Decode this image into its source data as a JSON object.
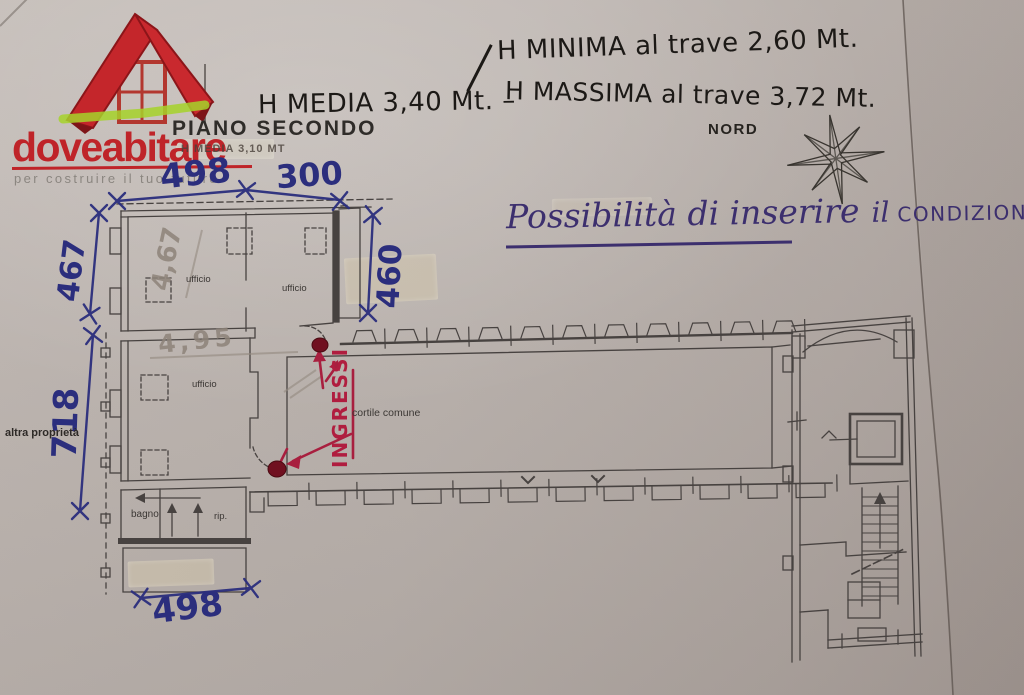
{
  "logo": {
    "brand": "doveabitare",
    "tagline": "per costruire il tuo futuro"
  },
  "header": {
    "floor_title": "PIANO SECONDO",
    "floor_subtitle": "H MEDIA 3,10 MT",
    "north_label": "NORD"
  },
  "handwritten_notes": {
    "h_minima": "H MINIMA al trave 2,60 Mt.",
    "h_media": "H MEDIA 3,40 Mt. –",
    "h_massima": "H MASSIMA al trave 3,72 Mt.",
    "possibilita_script": "Possibilità di inserire",
    "possibilita_article": "il",
    "possibilita_caps": "CONDIZIONATORE.",
    "ingressi": "INGRESSI"
  },
  "dimensions_cm": {
    "top_left": "498",
    "top_right": "300",
    "upper_left_side": "467",
    "upper_right_side": "460",
    "lower_left_side": "718",
    "bottom": "498",
    "pencil_upper_room": "4,67",
    "pencil_lower_room": "4,95"
  },
  "room_labels": {
    "office_top_left": "ufficio",
    "office_top_right": "ufficio",
    "office_middle": "ufficio",
    "courtyard": "cortile comune",
    "bathroom": "bagno",
    "storage": "rip.",
    "neighbor": "altra proprietà"
  },
  "colors": {
    "paper": "#b7afaa",
    "plan_line": "#474240",
    "blue_ink": "#2b2e7d",
    "purple_ink": "#3c2f6e",
    "red_ink": "#a81f3f",
    "black_ink": "#1c1916",
    "pencil": "#8d837a",
    "brand_red": "#bf2429",
    "highlighter_green": "#a6d22a"
  }
}
